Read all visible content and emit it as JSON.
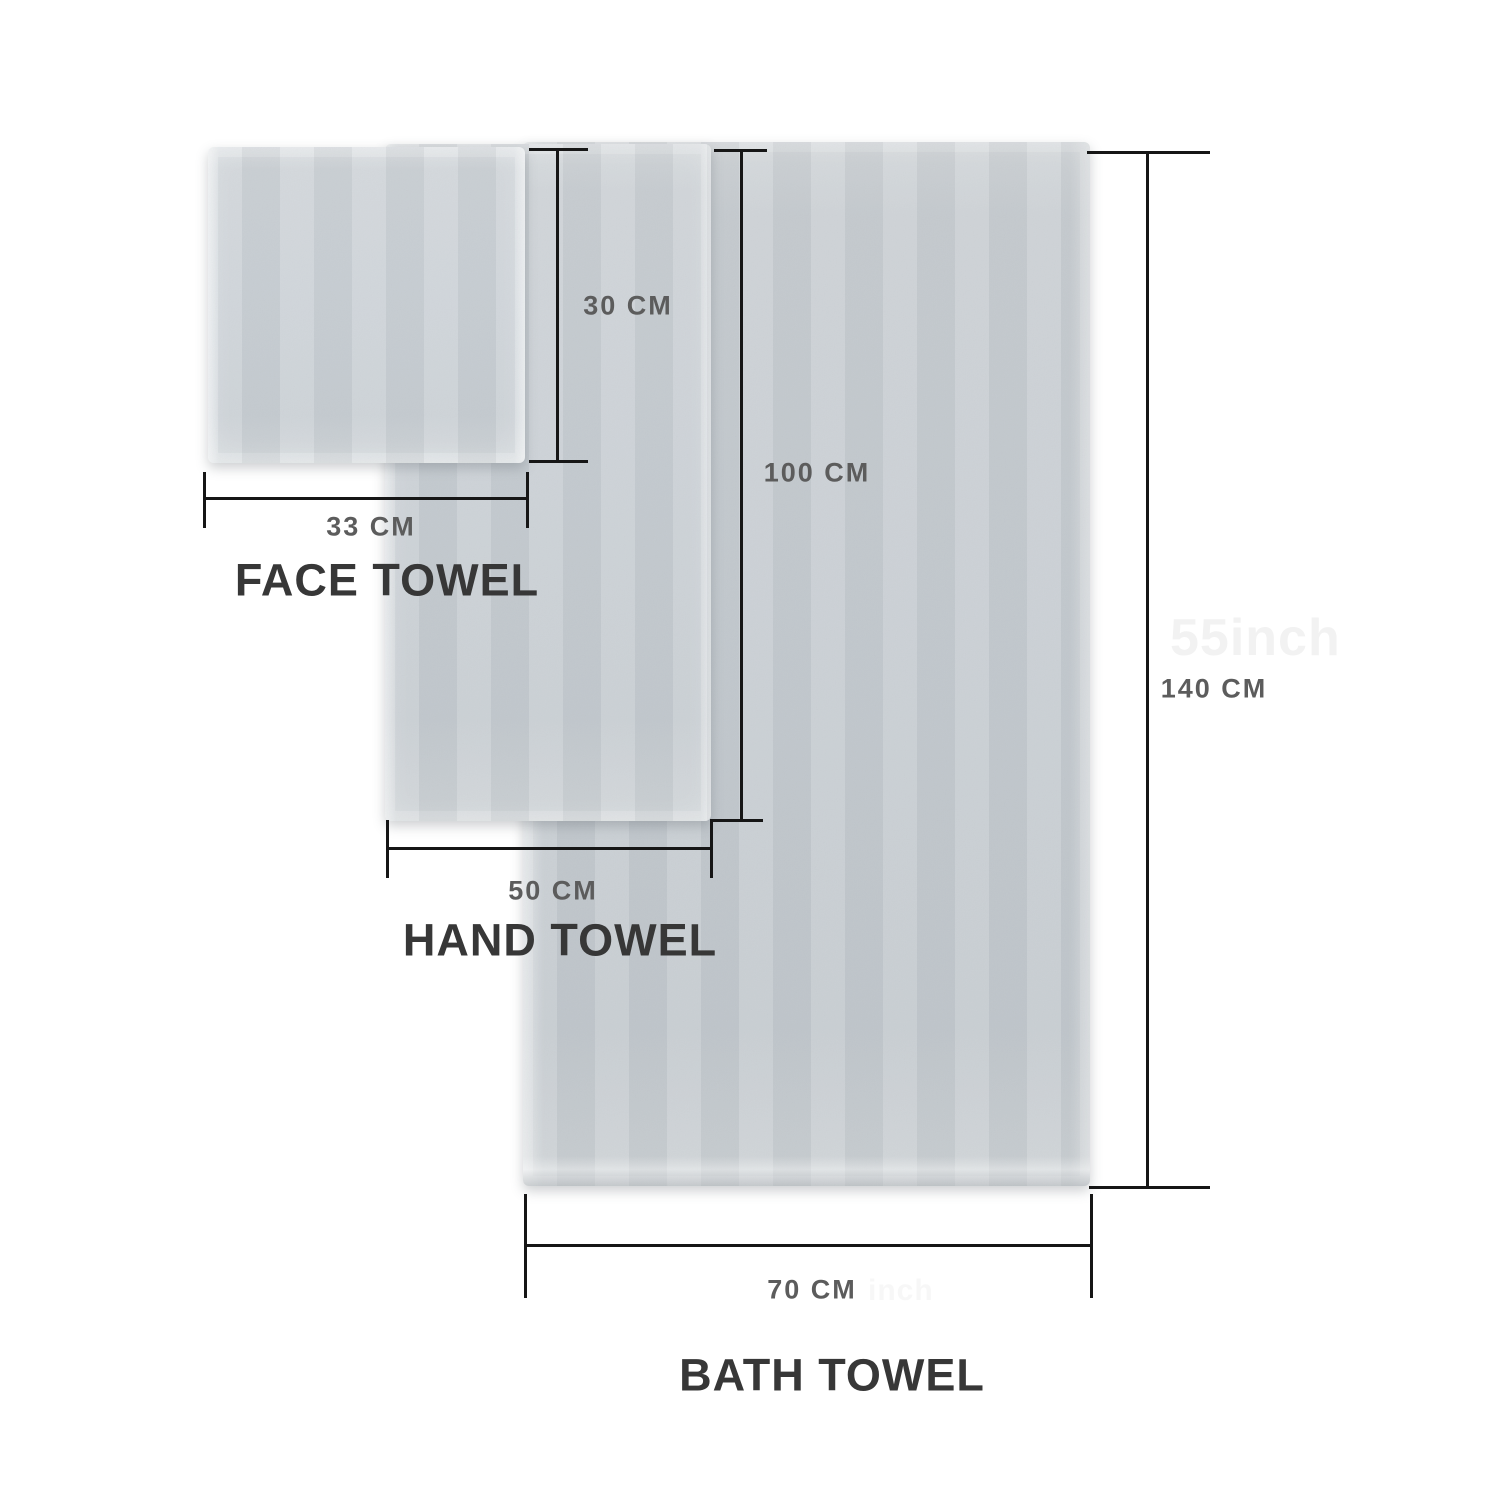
{
  "diagram": {
    "background_color": "#ffffff",
    "dimension_line_color": "#161616",
    "dimension_label_color": "#5c5c5c",
    "towel_name_color": "#373737",
    "towel_color": "#c8ced3",
    "watermark_color": "#f2f2f2",
    "towels": [
      {
        "name": "FACE TOWEL",
        "width_label": "33 CM",
        "height_label": "30 CM"
      },
      {
        "name": "HAND TOWEL",
        "width_label": "50 CM",
        "height_label": "100 CM"
      },
      {
        "name": "BATH TOWEL",
        "width_label": "70 CM",
        "height_label": "140 CM"
      }
    ],
    "watermarks": [
      {
        "text": "55inch"
      },
      {
        "text": "inch"
      }
    ]
  }
}
